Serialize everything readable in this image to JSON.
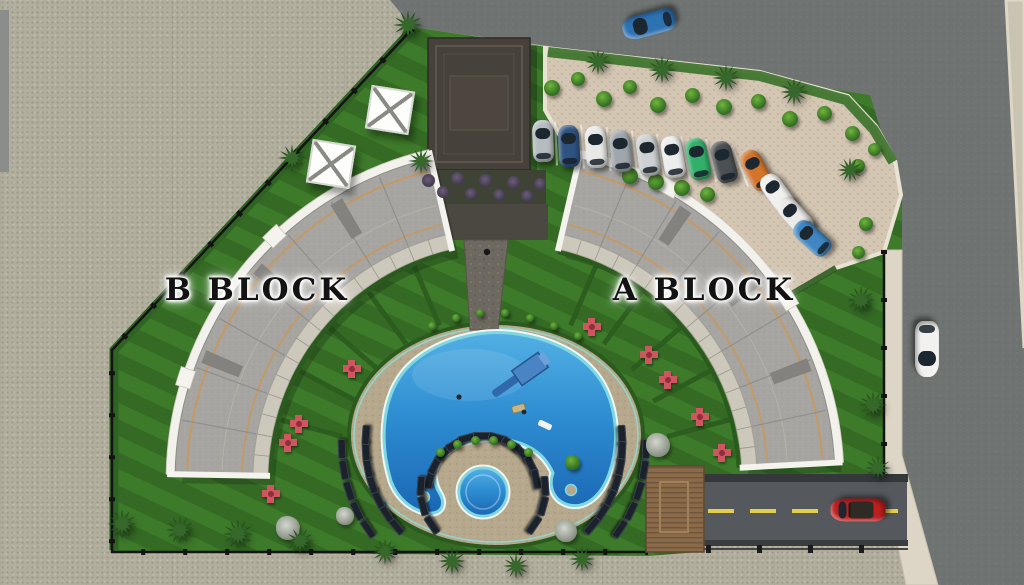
{
  "scene": {
    "type": "3d-rendered residential site plan, top view",
    "blocks": [
      {
        "id": "b",
        "label": "B BLOCK"
      },
      {
        "id": "a",
        "label": "A BLOCK"
      }
    ]
  },
  "labels": {
    "b_block": "B BLOCK",
    "a_block": "A BLOCK"
  },
  "palette": {
    "ground": "#b2ae9d",
    "road": "#6f7472",
    "sidewalk": "#ddd6c6",
    "lawn": "#3d7a2a",
    "hedge": "#2b5a1e",
    "parking": "#d3c6b3",
    "deck": "#b5a88c",
    "pool_deep": "#1a67b4",
    "pool_light": "#53b0e4",
    "pool_edge": "#7fd7e2",
    "roof": "#a6a5a1",
    "roof_trim": "#c29a68",
    "building_edge": "#f2f1ec",
    "clubhouse": "#46413a",
    "driveway": "#55585c",
    "lane_marking": "#e2cf4b",
    "fence": "#141414",
    "label_color": "#131313",
    "wood_deck": "#8a6a48"
  },
  "geometry": {
    "block_center": {
      "x": 505,
      "y": 480
    },
    "blocks": [
      {
        "name": "b-block",
        "a1": 181,
        "a2": 257,
        "r_in": 237,
        "r_out": 330
      },
      {
        "name": "a-block",
        "a1": 283,
        "a2": 357,
        "r_in": 237,
        "r_out": 330
      }
    ],
    "hedge_spokes": [
      {
        "from": 195,
        "to": 247,
        "count": 5,
        "r1": 168,
        "r2": 232
      },
      {
        "from": 293,
        "to": 345,
        "count": 5,
        "r1": 168,
        "r2": 232
      }
    ]
  },
  "pool": {
    "lounger_arcs": [
      {
        "cx": 483,
        "cy": 490,
        "r": 54,
        "a1": 192,
        "a2": 348,
        "n": 11
      },
      {
        "cx": 483,
        "cy": 490,
        "r": 62,
        "a1": 146,
        "a2": 184,
        "n": 3
      },
      {
        "cx": 483,
        "cy": 490,
        "r": 62,
        "a1": -4,
        "a2": 34,
        "n": 3
      },
      {
        "cx": 494,
        "cy": 444,
        "r": 128,
        "a1": 140,
        "a2": 184,
        "n": 7
      },
      {
        "cx": 494,
        "cy": 444,
        "r": 128,
        "a1": -4,
        "a2": 40,
        "n": 7
      },
      {
        "cx": 494,
        "cy": 444,
        "r": 152,
        "a1": 146,
        "a2": 178,
        "n": 5
      },
      {
        "cx": 494,
        "cy": 444,
        "r": 152,
        "a1": 2,
        "a2": 34,
        "n": 5
      }
    ],
    "features": [
      "main-pool",
      "kids-pool",
      "water-slide",
      "pool-floats"
    ]
  },
  "vehicles": {
    "parked_size": {
      "w": 21,
      "h": 42
    },
    "parked": [
      {
        "color": "#b7bcc0",
        "x": 543,
        "y": 141,
        "rot": -2
      },
      {
        "color": "#2e5380",
        "x": 569,
        "y": 146,
        "rot": -3
      },
      {
        "color": "#e9eae8",
        "x": 596,
        "y": 147,
        "rot": -4
      },
      {
        "color": "#9fa6ac",
        "x": 621,
        "y": 151,
        "rot": -6
      },
      {
        "color": "#cdd1d3",
        "x": 648,
        "y": 155,
        "rot": -8
      },
      {
        "color": "#eceded",
        "x": 673,
        "y": 157,
        "rot": -10
      },
      {
        "color": "#31b06a",
        "x": 698,
        "y": 159,
        "rot": -12
      },
      {
        "color": "#4b5054",
        "x": 724,
        "y": 162,
        "rot": -15
      },
      {
        "color": "#d3742b",
        "x": 756,
        "y": 170,
        "rot": -28
      },
      {
        "color": "#f0f0ee",
        "x": 777,
        "y": 193,
        "rot": -36
      },
      {
        "color": "#eaeae8",
        "x": 795,
        "y": 216,
        "rot": -42
      },
      {
        "color": "#3f86c2",
        "x": 812,
        "y": 238,
        "rot": -48
      }
    ],
    "moving": [
      {
        "name": "car-top-road",
        "color": "#2f72b2",
        "x": 649,
        "y": 24,
        "rot": 255,
        "w": 23,
        "h": 54,
        "convertible": false
      },
      {
        "name": "car-right-road",
        "color": "#f1f1ef",
        "x": 927,
        "y": 349,
        "rot": 180,
        "w": 24,
        "h": 56,
        "convertible": false
      },
      {
        "name": "car-entrance",
        "color": "#bf1f1f",
        "x": 858,
        "y": 510,
        "rot": 270,
        "w": 23,
        "h": 55,
        "convertible": true
      }
    ]
  },
  "vegetation": {
    "palms": [
      [
        408,
        25,
        30
      ],
      [
        421,
        161,
        26
      ],
      [
        292,
        158,
        28
      ],
      [
        122,
        524,
        30
      ],
      [
        180,
        530,
        28
      ],
      [
        238,
        534,
        30
      ],
      [
        300,
        541,
        28
      ],
      [
        385,
        552,
        26
      ],
      [
        452,
        561,
        28
      ],
      [
        516,
        566,
        26
      ],
      [
        582,
        559,
        26
      ],
      [
        598,
        62,
        26
      ],
      [
        662,
        70,
        28
      ],
      [
        726,
        78,
        28
      ],
      [
        794,
        92,
        28
      ],
      [
        850,
        170,
        26
      ],
      [
        861,
        300,
        28
      ],
      [
        873,
        405,
        28
      ],
      [
        878,
        468,
        26
      ]
    ],
    "bushes": [
      [
        552,
        88,
        16
      ],
      [
        578,
        79,
        14
      ],
      [
        604,
        99,
        16
      ],
      [
        630,
        87,
        14
      ],
      [
        658,
        105,
        16
      ],
      [
        692,
        95,
        15
      ],
      [
        724,
        107,
        16
      ],
      [
        758,
        101,
        15
      ],
      [
        790,
        119,
        16
      ],
      [
        824,
        113,
        15
      ],
      [
        852,
        133,
        15
      ],
      [
        874,
        149,
        13
      ],
      [
        630,
        176,
        16
      ],
      [
        656,
        182,
        16
      ],
      [
        682,
        188,
        16
      ],
      [
        707,
        194,
        15
      ],
      [
        858,
        166,
        14
      ],
      [
        866,
        224,
        14
      ],
      [
        858,
        252,
        13
      ],
      [
        572,
        462,
        15
      ],
      [
        432,
        326,
        8
      ],
      [
        456,
        318,
        8
      ],
      [
        480,
        313,
        8
      ],
      [
        505,
        313,
        8
      ],
      [
        530,
        318,
        8
      ],
      [
        554,
        326,
        8
      ],
      [
        578,
        336,
        8
      ],
      [
        440,
        452,
        9
      ],
      [
        457,
        444,
        9
      ],
      [
        475,
        440,
        9
      ],
      [
        493,
        440,
        9
      ],
      [
        511,
        444,
        9
      ],
      [
        528,
        452,
        9
      ]
    ],
    "gray_shrubs": [
      [
        288,
        528,
        24
      ],
      [
        566,
        531,
        22
      ],
      [
        658,
        445,
        24
      ],
      [
        345,
        516,
        18
      ]
    ],
    "lavender": [
      [
        428,
        180,
        13
      ],
      [
        443,
        192,
        12
      ],
      [
        457,
        178,
        13
      ],
      [
        471,
        194,
        12
      ],
      [
        485,
        180,
        13
      ],
      [
        499,
        195,
        12
      ],
      [
        513,
        182,
        13
      ],
      [
        527,
        196,
        12
      ],
      [
        540,
        184,
        12
      ]
    ],
    "flower_seats": [
      [
        352,
        369
      ],
      [
        299,
        424
      ],
      [
        288,
        443
      ],
      [
        271,
        494
      ],
      [
        592,
        327
      ],
      [
        649,
        355
      ],
      [
        668,
        380
      ],
      [
        700,
        417
      ],
      [
        722,
        453
      ]
    ]
  },
  "structures": {
    "pergolas": [
      {
        "x": 390,
        "y": 110,
        "rot": 9,
        "size": 40
      },
      {
        "x": 331,
        "y": 164,
        "rot": 9,
        "size": 40
      }
    ],
    "clubhouse": "dark flat-roof social facility",
    "wooden_deck": "timber platform at pool entrance"
  }
}
